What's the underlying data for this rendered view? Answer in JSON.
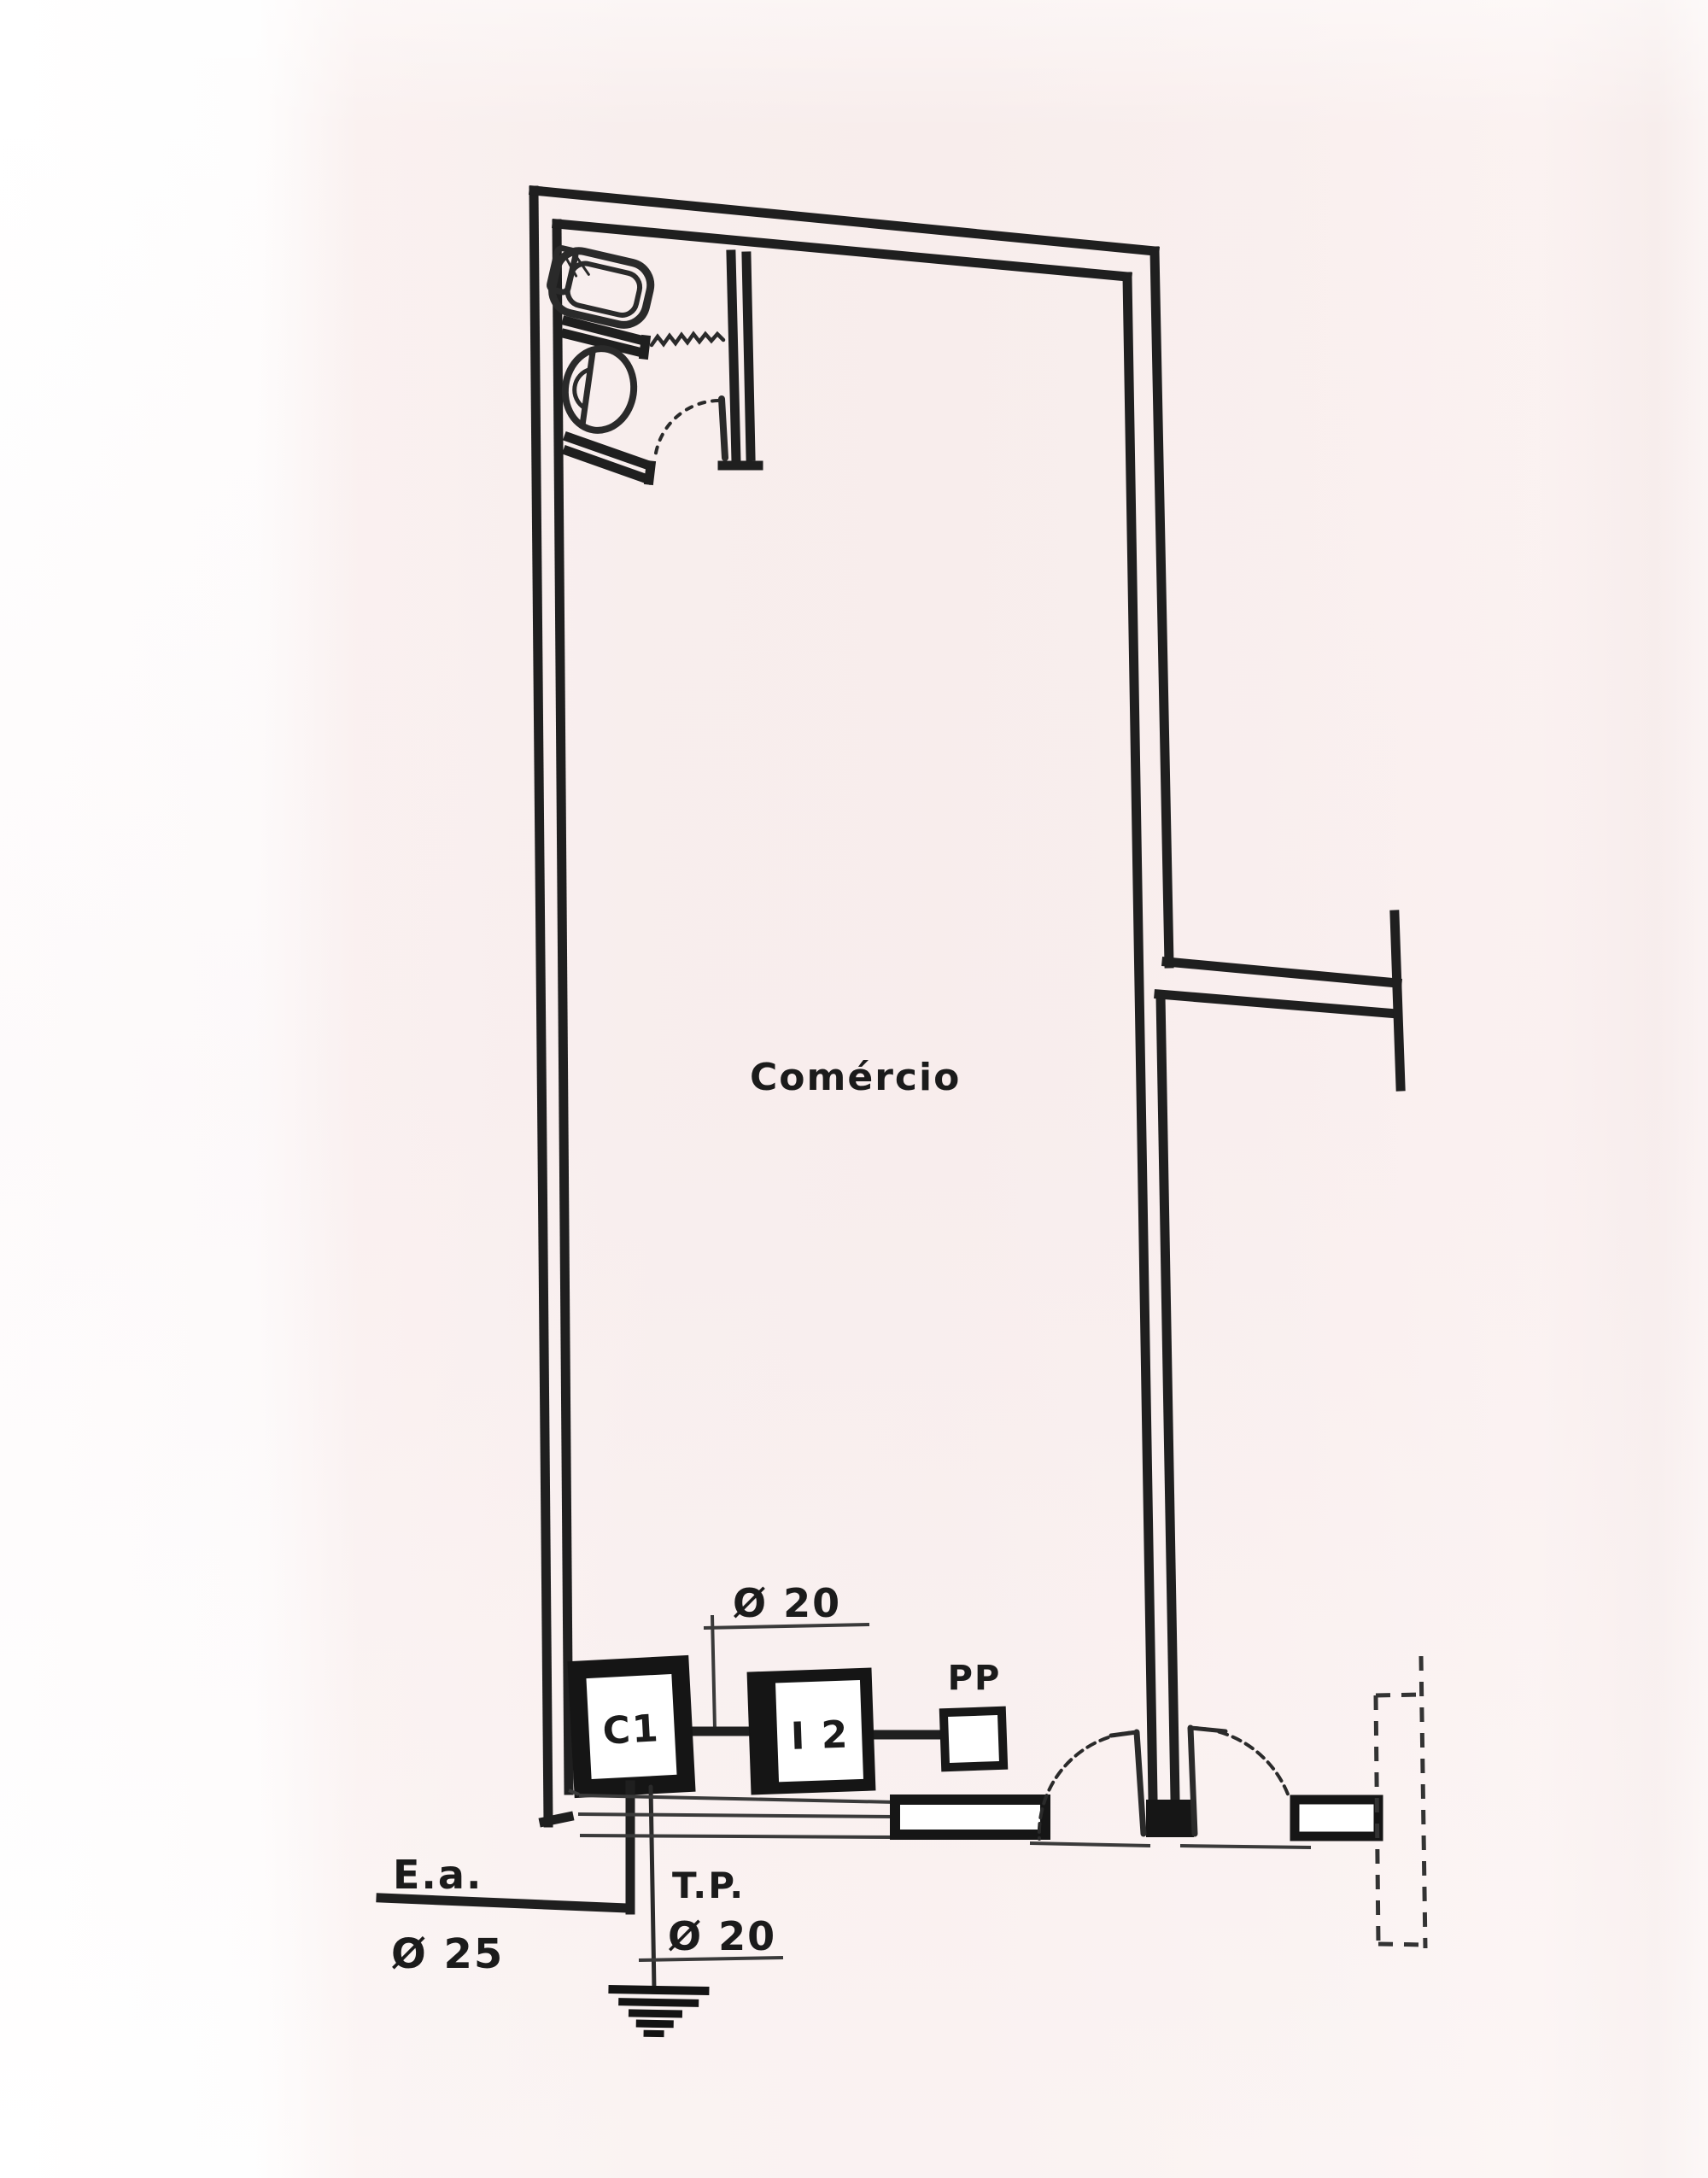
{
  "document": {
    "kind": "scanned floor plan diagram",
    "room_label": "Comércio"
  },
  "labels": {
    "room": "Comércio",
    "dim_top": "Ø 20",
    "box_c1": "C1",
    "box_i2": "I 2",
    "outlet_pp": "PP",
    "entrance": "E.a.",
    "entrance_dim": "Ø 25",
    "ground": "T.P.",
    "ground_dim": "Ø 20"
  },
  "colors": {
    "paper": "#f8eeed",
    "paper_edge": "#ffffff",
    "ink": "#1f1f1f",
    "thin_line": "#3a3a3a",
    "arc_line": "#555555"
  }
}
